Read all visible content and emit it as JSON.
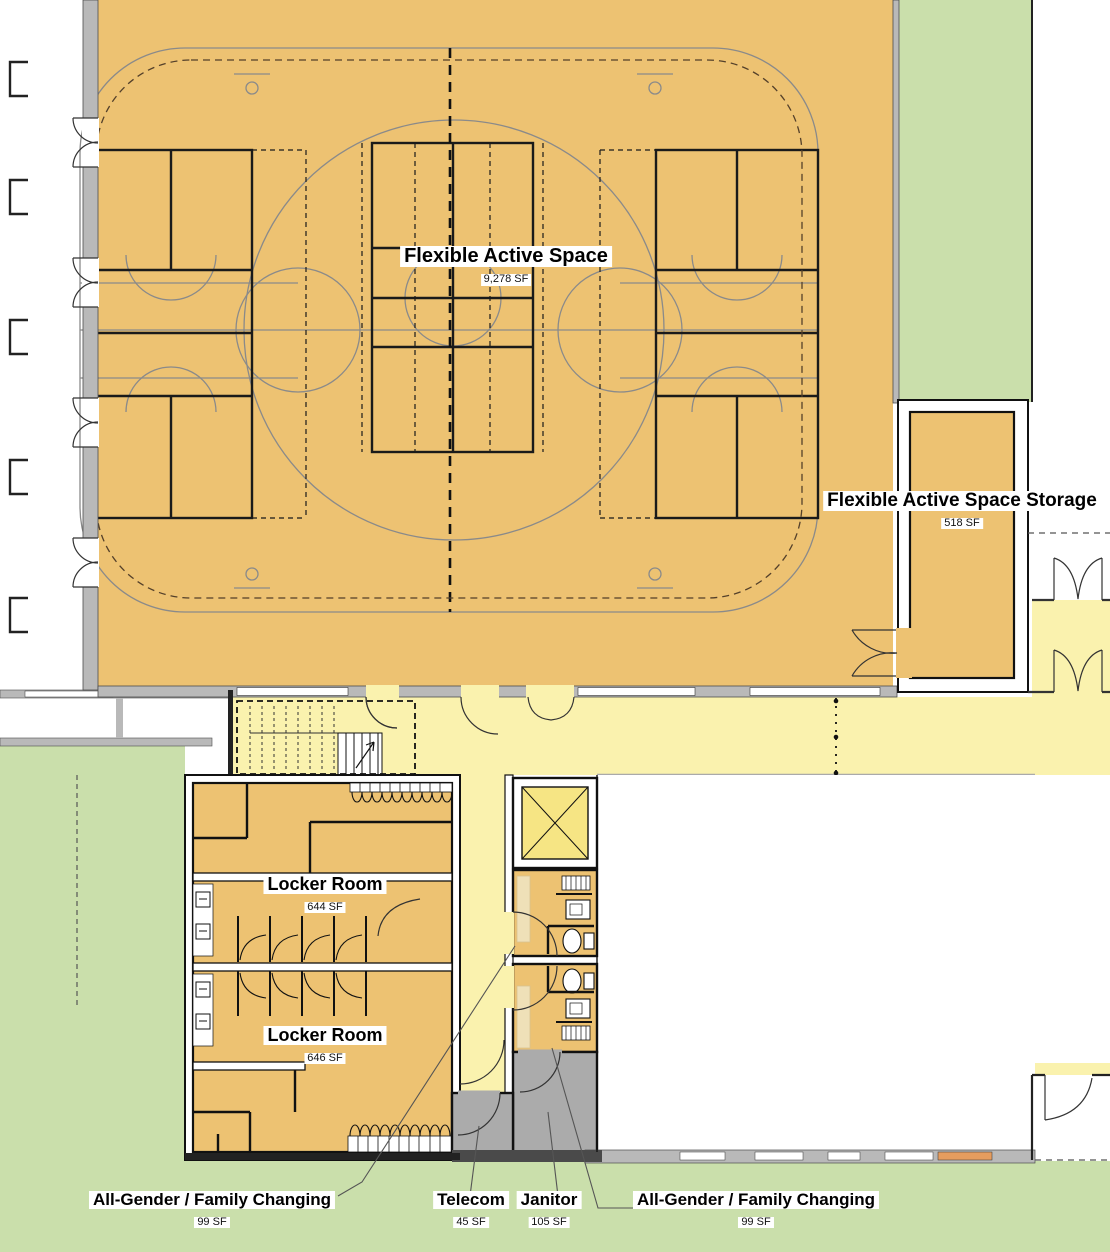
{
  "plan": {
    "type": "architectural floor plan",
    "level": "recreation center gym and locker level"
  },
  "rooms": {
    "flexible_active_space": {
      "name": "Flexible Active Space",
      "area": "9,278 SF"
    },
    "flexible_active_space_storage": {
      "name": "Flexible Active Space Storage",
      "area": "518 SF"
    },
    "locker_room_north": {
      "name": "Locker Room",
      "area": "644 SF"
    },
    "locker_room_south": {
      "name": "Locker Room",
      "area": "646 SF"
    },
    "all_gender_family_changing_west": {
      "name": "All-Gender / Family Changing",
      "area": "99 SF"
    },
    "telecom": {
      "name": "Telecom",
      "area": "45 SF"
    },
    "janitor": {
      "name": "Janitor",
      "area": "105 SF"
    },
    "all_gender_family_changing_east": {
      "name": "All-Gender / Family Changing",
      "area": "99 SF"
    }
  },
  "colors": {
    "gym_floor": "#edc272",
    "corridor_yellow": "#faf2ae",
    "elevator_yellow": "#f6e584",
    "landscape_green": "#cadfab",
    "service_gray": "#ababab",
    "wall_gray": "#b9b9b9",
    "court_line_gray": "#8a8a8a",
    "bench_tan": "#efe0b8"
  }
}
